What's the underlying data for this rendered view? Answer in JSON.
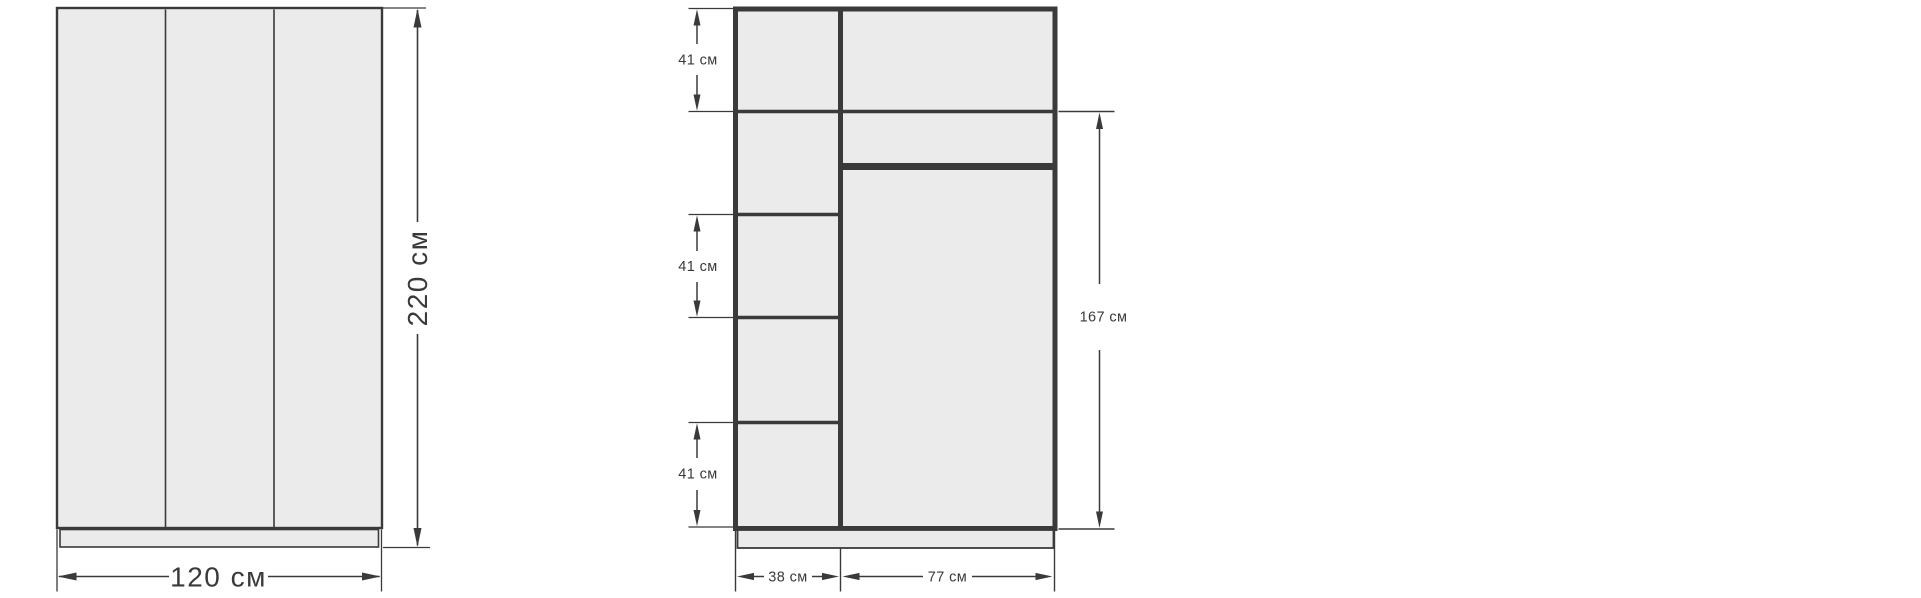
{
  "diagram": {
    "subject": "wardrobe dimensions drawing",
    "units": "см",
    "colors": {
      "line": "#3a3a3a",
      "fill": "#ebebeb",
      "background": "#ffffff"
    },
    "front_view": {
      "name": "front view",
      "door_count": 3,
      "width": {
        "value": 120,
        "label": "120 см"
      },
      "height": {
        "value": 220,
        "label": "220 см"
      }
    },
    "interior_view": {
      "name": "interior layout view",
      "left_column": {
        "width": {
          "value": 38,
          "label": "38 см"
        },
        "shelf_dimensions": [
          {
            "value": 41,
            "label": "41 см"
          },
          {
            "value": 41,
            "label": "41 см"
          },
          {
            "value": 41,
            "label": "41 см"
          }
        ]
      },
      "right_column": {
        "width": {
          "value": 77,
          "label": "77 см"
        },
        "hanging_height": {
          "value": 167,
          "label": "167 см"
        }
      }
    }
  }
}
